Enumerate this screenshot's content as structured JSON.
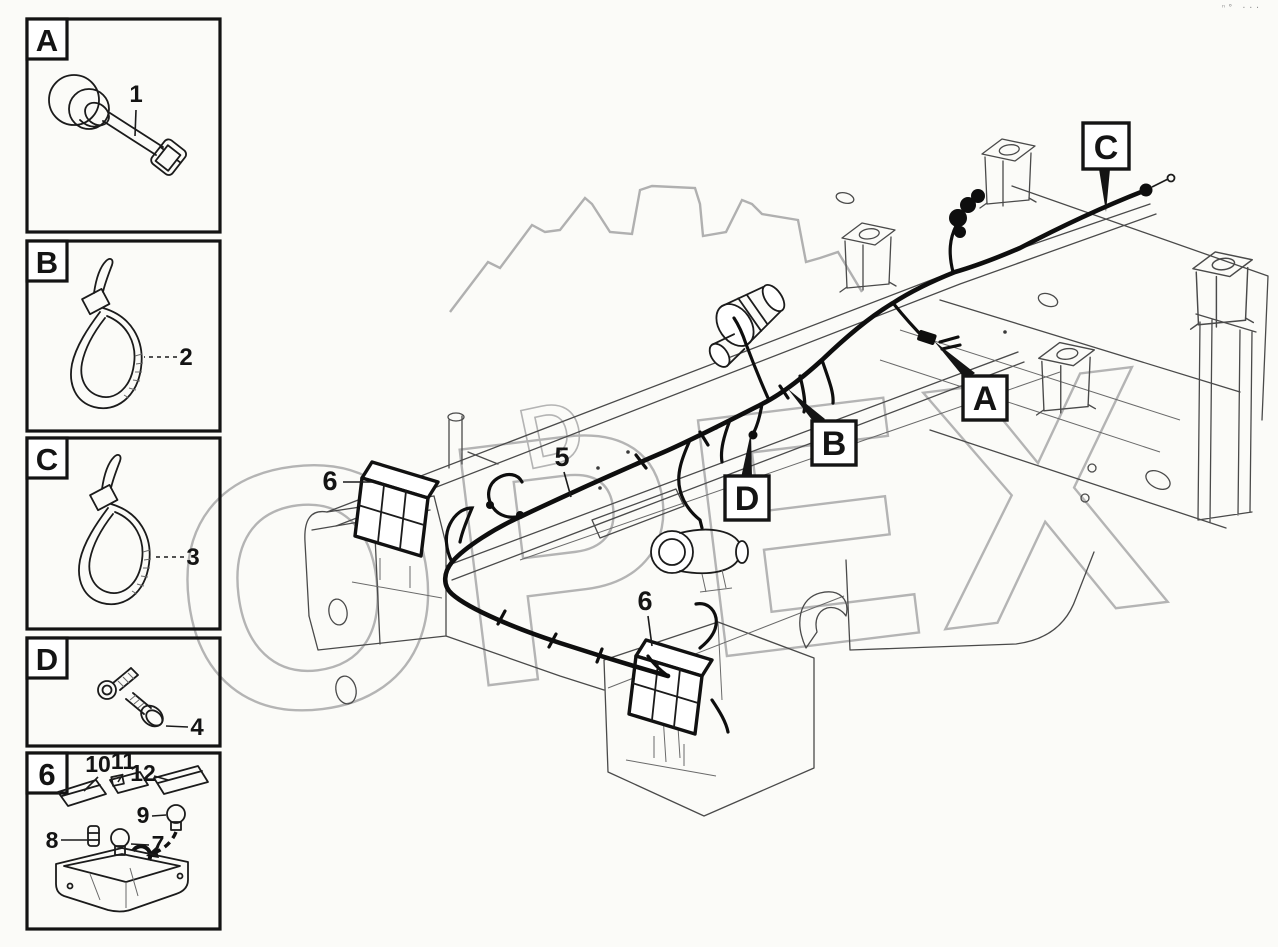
{
  "page": {
    "corner_mark": "ⁿ° ···"
  },
  "watermark": {
    "brand": "ОРЕХ",
    "secondary_letter": "D",
    "color": "#b4b4b4"
  },
  "sidebar": {
    "boxes": [
      {
        "label": "A",
        "callouts": [
          "1"
        ]
      },
      {
        "label": "B",
        "callouts": [
          "2"
        ]
      },
      {
        "label": "C",
        "callouts": [
          "3"
        ]
      },
      {
        "label": "D",
        "callouts": [
          "4"
        ]
      },
      {
        "label": "6",
        "callouts": [
          "10",
          "11",
          "12",
          "9",
          "8",
          "7"
        ]
      }
    ]
  },
  "main": {
    "ref_labels": [
      "C",
      "A",
      "B",
      "D"
    ],
    "item_labels": [
      "5",
      "6",
      "6"
    ]
  },
  "colors": {
    "ink": "#141414",
    "frame_line": "#4a4a4a",
    "watermark": "#b4b4b4",
    "background": "#fbfbf8"
  }
}
